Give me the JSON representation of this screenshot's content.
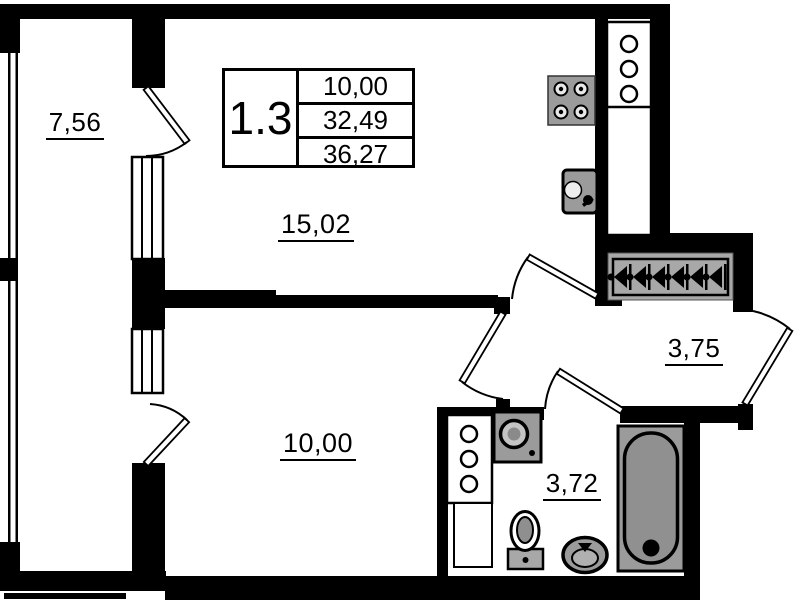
{
  "floor_plan": {
    "unit": {
      "number": "1.3",
      "areas": {
        "living_area": "10,00",
        "apartment_area": "32,49",
        "total_area": "36,27"
      }
    },
    "rooms": {
      "balcony": {
        "area": "7,56"
      },
      "living": {
        "area": "15,02"
      },
      "bedroom": {
        "area": "10,00"
      },
      "hallway": {
        "area": "3,75"
      },
      "bathroom": {
        "area": "3,72"
      }
    },
    "fixtures": [
      "stove-icon",
      "kitchen-sink-icon",
      "ventilation-shaft-kitchen",
      "wardrobe-hangers",
      "washing-machine-icon",
      "ventilation-shaft-bathroom",
      "toilet-icon",
      "bathroom-sink-icon",
      "bathtub-icon"
    ],
    "colors": {
      "wall": "#000000",
      "fixture_gray": "#9b9b9b",
      "background": "#ffffff"
    }
  }
}
